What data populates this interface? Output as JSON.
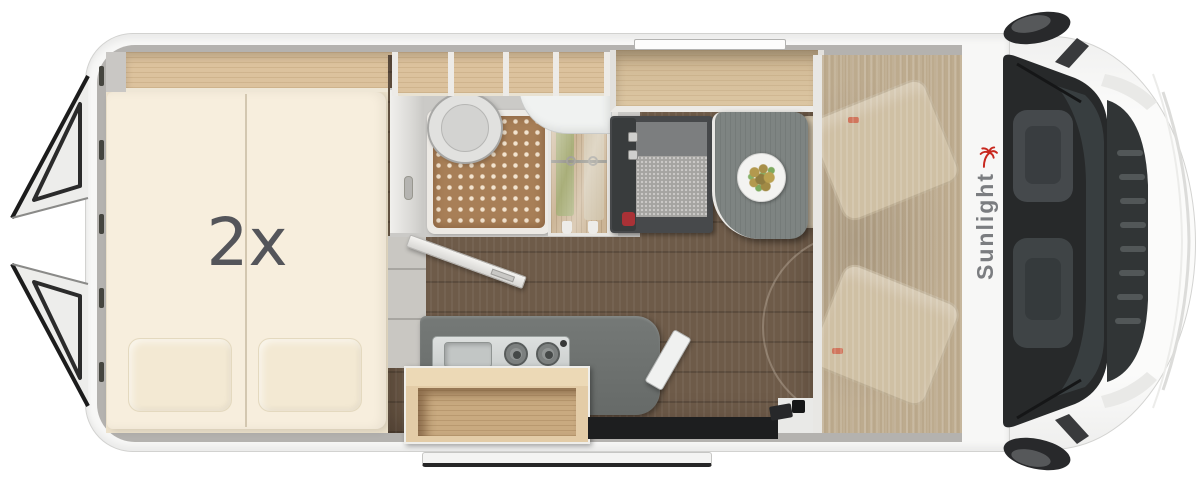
{
  "labels": {
    "bed_quantity": "2x",
    "brand": "Sunlight"
  },
  "areas": {
    "rear_bed": "rear-transverse-double-bed",
    "bathroom": "wet-room-with-shower-toilet-sink",
    "wardrobe": "wardrobe-with-hanging-clothes",
    "kitchen": "kitchen-block-sink-and-two-burner-hob",
    "dinette": "bench-seat-with-table-and-meal-plate",
    "cab": "driver-cab-two-swivel-seats-under-roof",
    "entry": "sliding-door-entry-step",
    "rear_doors": "open-rear-barn-doors"
  },
  "colors": {
    "brand_red": "#c8281f",
    "brand_text_gray": "#7b7d80",
    "body_white": "#f7f7f6",
    "wall_gray": "#b4b2af",
    "wood_shelf": "#dcc29d",
    "mattress_beige": "#f7eedd",
    "floor_brown": "#6e5b49",
    "shower_tile": "#a87f57",
    "counter_gray": "#6b6f6d",
    "table_gray": "#7e8482",
    "seat_accent_red": "#da4430",
    "windshield_dark": "#27292a"
  }
}
